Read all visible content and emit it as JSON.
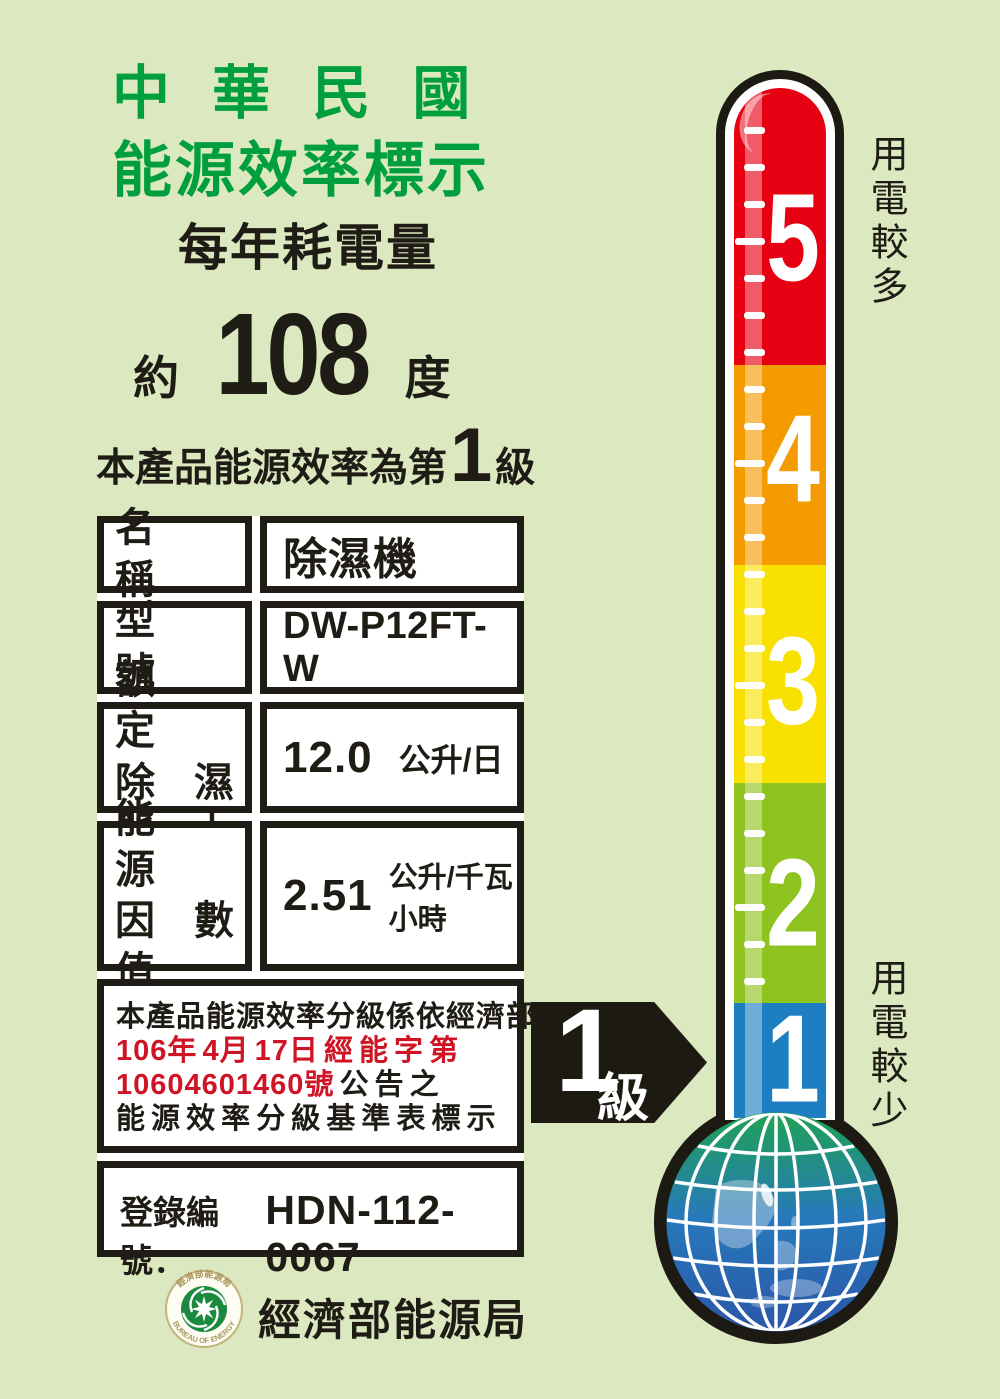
{
  "header": {
    "title_line1": "中 華 民 國",
    "title_line2": "能源效率標示",
    "subtitle": "每年耗電量",
    "consumption": {
      "prefix": "約",
      "value": "108",
      "unit": "度"
    },
    "grade_line": {
      "prefix": "本產品能源效率為第",
      "grade": "1",
      "suffix": "級"
    }
  },
  "table": {
    "rows": [
      {
        "label": "名　稱",
        "value": "除濕機",
        "unit": ""
      },
      {
        "label": "型　號",
        "value": "DW-P12FT-W",
        "unit": ""
      },
      {
        "label_line1": "額　定",
        "label_line2": "除濕能力",
        "value": "12.0",
        "unit": "公升/日"
      },
      {
        "label_line1": "能　源",
        "label_line2": "因數值",
        "value": "2.51",
        "unit": "公升/千瓦小時"
      }
    ],
    "notice": {
      "line1": "本產品能源效率分級係依經濟部",
      "line2": "106年 4月 17日 經 能 字 第",
      "line3_red": "10604601460號",
      "line3_black": " 公 告 之",
      "line4": "能 源 效 率 分 級 基 準 表 標 示"
    },
    "registration": {
      "label": "登錄編號：",
      "number": "HDN-112-0067"
    }
  },
  "arrow": {
    "grade": "1",
    "unit": "級"
  },
  "thermometer": {
    "scale": [
      {
        "level": "5",
        "color": "#e60012"
      },
      {
        "level": "4",
        "color": "#f49b00"
      },
      {
        "level": "3",
        "color": "#f8e100"
      },
      {
        "level": "2",
        "color": "#8fc31f"
      },
      {
        "level": "1",
        "color": "#1d7fc1"
      }
    ],
    "label_top": "用電較多",
    "label_bottom": "用電較少"
  },
  "footer": {
    "agency": "經濟部能源局",
    "seal_text_top": "經濟部能源局",
    "seal_text_bottom": "BUREAU OF ENERGY"
  },
  "colors": {
    "background": "#dce8bf",
    "title_green": "#009f3e",
    "text_black": "#1f1c15",
    "notice_red": "#cf1425",
    "arrow_black": "#1d1a12",
    "tube_outline": "#1d1a14",
    "tick_white": "#ffffff"
  }
}
